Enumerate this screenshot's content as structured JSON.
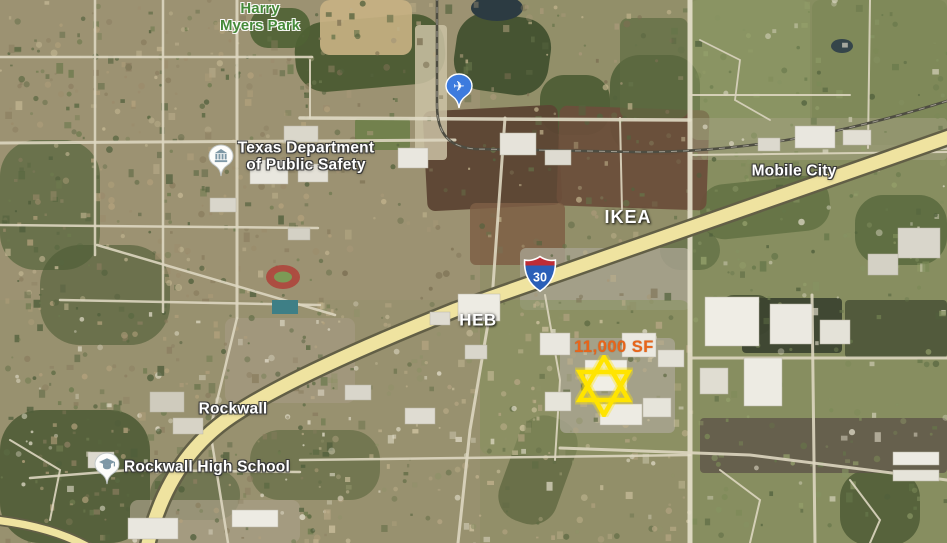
{
  "map": {
    "imagery_type": "satellite",
    "labels": {
      "park": {
        "line1": "Harry",
        "line2": "Myers Park"
      },
      "dps": {
        "line1": "Texas Department",
        "line2": "of Public Safety"
      },
      "mobile_city": "Mobile City",
      "ikea": "IKEA",
      "heb": "HEB",
      "rockwall": "Rockwall",
      "high_school": "Rockwall High School",
      "site_size": "11,000 SF"
    },
    "markers": {
      "interstate_shield": {
        "route": "30",
        "body_color": "#2B5FB8",
        "band_color": "#BE2C35"
      },
      "airport": {
        "glyph": "✈",
        "color": "#3D7BDE"
      },
      "government": {
        "icon": "government-building",
        "color": "#7E98A6"
      },
      "school": {
        "icon": "graduation-cap",
        "color": "#7E98A6"
      },
      "site_star": {
        "shape": "six-pointed-star",
        "color": "#FFE400"
      }
    },
    "colors": {
      "park_label": "#468A39",
      "poi_label": "#FFFFFF",
      "site_label": "#E8651A",
      "highway_fill": "#EFE3A0"
    }
  }
}
